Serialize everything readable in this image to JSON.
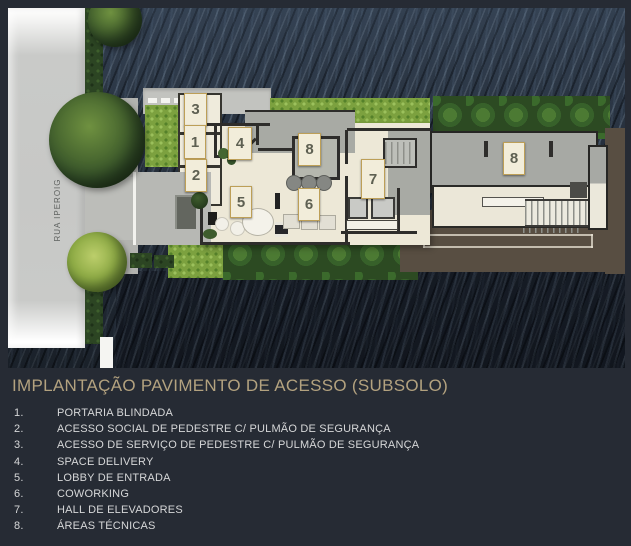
{
  "header": {
    "title": "IMPLANTAÇÃO PAVIMENTO DE ACESSO (SUBSOLO)"
  },
  "plan": {
    "street_label": "RUA IPEROIG",
    "markers": [
      {
        "label": "3",
        "x": 176,
        "y": 85,
        "w": 21,
        "h": 31
      },
      {
        "label": "1",
        "x": 176,
        "y": 117,
        "w": 20,
        "h": 32
      },
      {
        "label": "2",
        "x": 177,
        "y": 151,
        "w": 20,
        "h": 31
      },
      {
        "label": "4",
        "x": 220,
        "y": 119,
        "w": 22,
        "h": 31
      },
      {
        "label": "8",
        "x": 290,
        "y": 125,
        "w": 21,
        "h": 31
      },
      {
        "label": "5",
        "x": 222,
        "y": 178,
        "w": 20,
        "h": 30
      },
      {
        "label": "6",
        "x": 290,
        "y": 180,
        "w": 20,
        "h": 31
      },
      {
        "label": "7",
        "x": 353,
        "y": 151,
        "w": 22,
        "h": 38
      },
      {
        "label": "8",
        "x": 495,
        "y": 134,
        "w": 20,
        "h": 31
      }
    ]
  },
  "legend": {
    "items": [
      {
        "num": "1.",
        "label": "PORTARIA BLINDADA"
      },
      {
        "num": "2.",
        "label": "ACESSO SOCIAL DE PEDESTRE C/ PULMÃO DE SEGURANÇA"
      },
      {
        "num": "3.",
        "label": "ACESSO DE SERVIÇO DE PEDESTRE C/ PULMÃO DE SEGURANÇA"
      },
      {
        "num": "4.",
        "label": "SPACE DELIVERY"
      },
      {
        "num": "5.",
        "label": "LOBBY DE ENTRADA"
      },
      {
        "num": "6.",
        "label": "COWORKING"
      },
      {
        "num": "7.",
        "label": "HALL DE ELEVADORES"
      },
      {
        "num": "8.",
        "label": "ÁREAS TÉCNICAS"
      }
    ]
  },
  "colors": {
    "background": "#262B34",
    "title": "#B3A27F",
    "legend_text": "#D6D7D8",
    "marker_bg": "#F2EDDA",
    "marker_border": "#BD9F57",
    "marker_text": "#5E6052",
    "marble": "#28323F",
    "street": "#C7C8C6",
    "building_cream": "#EDE8D7",
    "building_gray": "#A8AAA4",
    "building_brown": "#584E42",
    "lawn_green": "#7CA13F",
    "hedge_green": "#2C4523"
  }
}
